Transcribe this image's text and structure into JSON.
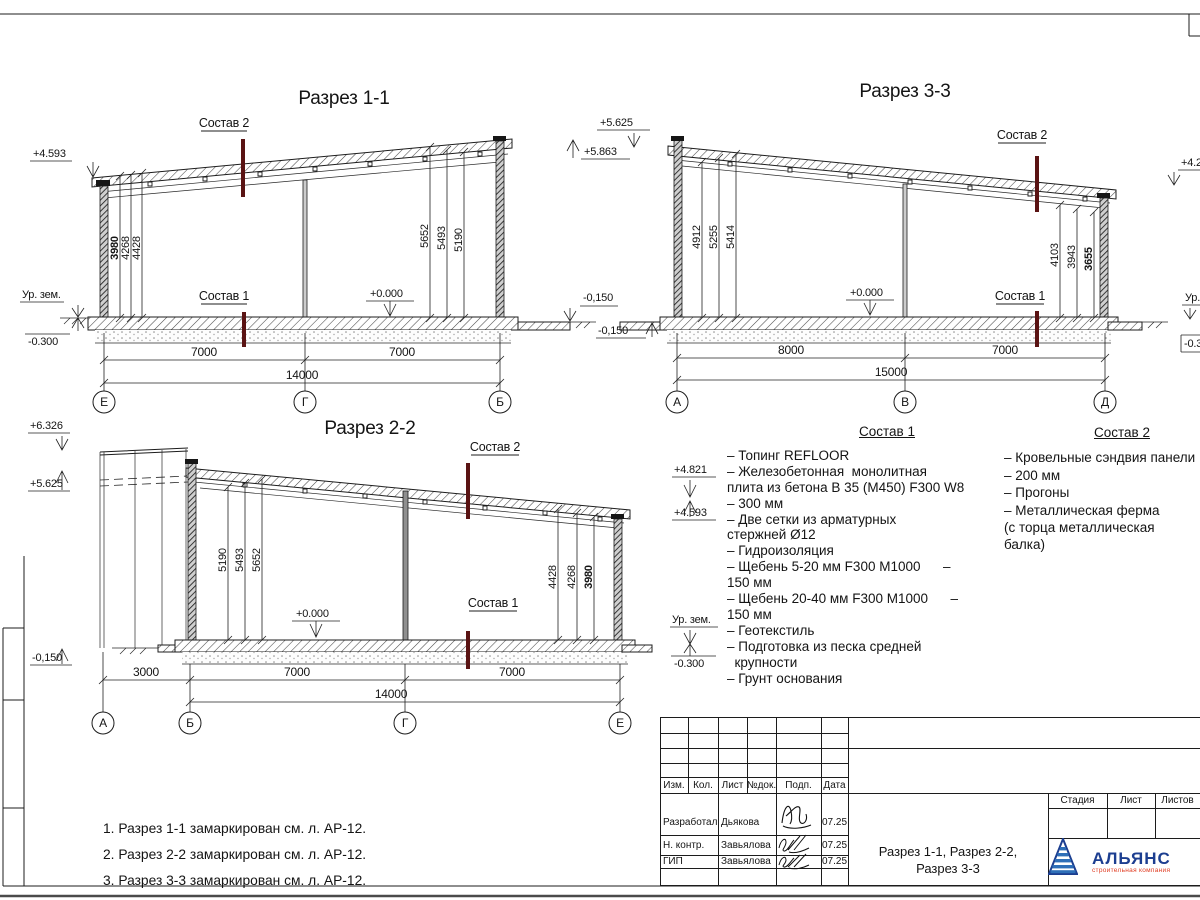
{
  "sheet": {
    "notes": [
      "1. Разрез 1-1 замаркирован см. л. АР-12.",
      "2. Разрез 2-2 замаркирован см. л. АР-12.",
      "3. Разрез 3-3 замаркирован см. л. АР-12."
    ]
  },
  "s11": {
    "title": "Разрез 1-1",
    "sostav2": "Состав 2",
    "sostav1": "Состав 1",
    "elev_left_top": "+4.593",
    "ground_label": "Ур. зем.",
    "elev_left_bottom": "-0.300",
    "zero": "+0.000",
    "elev_right_top": "+5.625",
    "elev_right_mid": "+5.863",
    "elev_right_bottom": "-0,150",
    "dims_left": [
      "3980",
      "4268",
      "4428"
    ],
    "dims_right": [
      "5652",
      "5493",
      "5190"
    ],
    "spans": [
      "7000",
      "7000"
    ],
    "total": "14000",
    "axes": [
      "Е",
      "Г",
      "Б"
    ]
  },
  "s33": {
    "title": "Разрез 3-3",
    "sostav2": "Состав 2",
    "sostav1": "Состав 1",
    "elev_left_bottom": "-0,150",
    "zero": "+0.000",
    "elev_right_top": "+4.2",
    "ground_label_right": "Ур.",
    "elev_right_bottom": "-0.3",
    "dims_left": [
      "4912",
      "5255",
      "5414"
    ],
    "dims_right": [
      "4103",
      "3943",
      "3655"
    ],
    "spans": [
      "8000",
      "7000"
    ],
    "total": "15000",
    "axes": [
      "А",
      "В",
      "Д"
    ]
  },
  "s22": {
    "title": "Разрез 2-2",
    "sostav2": "Состав 2",
    "sostav1": "Состав 1",
    "elev_left_top": "+6.326",
    "elev_left_mid": "+5.625",
    "elev_left_bottom": "-0,150",
    "elev_right_top": "+4.821",
    "elev_right_mid": "+4.593",
    "ground_label": "Ур. зем.",
    "elev_right_bottom": "-0.300",
    "zero": "+0.000",
    "dims_left": [
      "5190",
      "5493",
      "5652"
    ],
    "dims_right": [
      "4428",
      "4268",
      "3980"
    ],
    "spans": [
      "3000",
      "7000",
      "7000"
    ],
    "total": "14000",
    "axes": [
      "А",
      "Б",
      "Г",
      "Е"
    ]
  },
  "sostav1_list": {
    "title": "Состав 1",
    "items": [
      "– Топинг REFLOOR",
      "– Железобетонная  монолитная\nплита из бетона В 35 (М450) F300 W8\n– 300 мм",
      "– Две сетки из арматурных\nстержней Ø12",
      "– Гидроизоляция",
      "– Щебень 5-20 мм F300 М1000      –\n150 мм",
      "– Щебень 20-40 мм F300 М1000      –\n150 мм",
      "– Геотекстиль",
      "– Подготовка из песка средней\n  крупности",
      "– Грунт основания"
    ]
  },
  "sostav2_list": {
    "title": "Состав 2",
    "items": [
      "– Кровельные сэндвия панели",
      "– 200 мм",
      "– Прогоны",
      "– Металлическая ферма\n(с торца металлическая\nбалка)"
    ]
  },
  "titleblock": {
    "cols": [
      "Изм.",
      "Кол.",
      "Лист",
      "№док.",
      "Подп.",
      "Дата"
    ],
    "rows": [
      {
        "role": "Разработал",
        "name": "Дьякова",
        "date": "07.25"
      },
      {
        "role": "Н. контр.",
        "name": "Завьялова",
        "date": "07.25"
      },
      {
        "role": "ГИП",
        "name": "Завьялова",
        "date": "07.25"
      }
    ],
    "stage": {
      "stadia": "Стадия",
      "list": "Лист",
      "listov": "Листов"
    },
    "doc_title1": "Разрез 1-1, Разрез 2-2,",
    "doc_title2": "Разрез 3-3",
    "logo_name": "АЛЬЯНС",
    "logo_sub": "строительная компания"
  }
}
